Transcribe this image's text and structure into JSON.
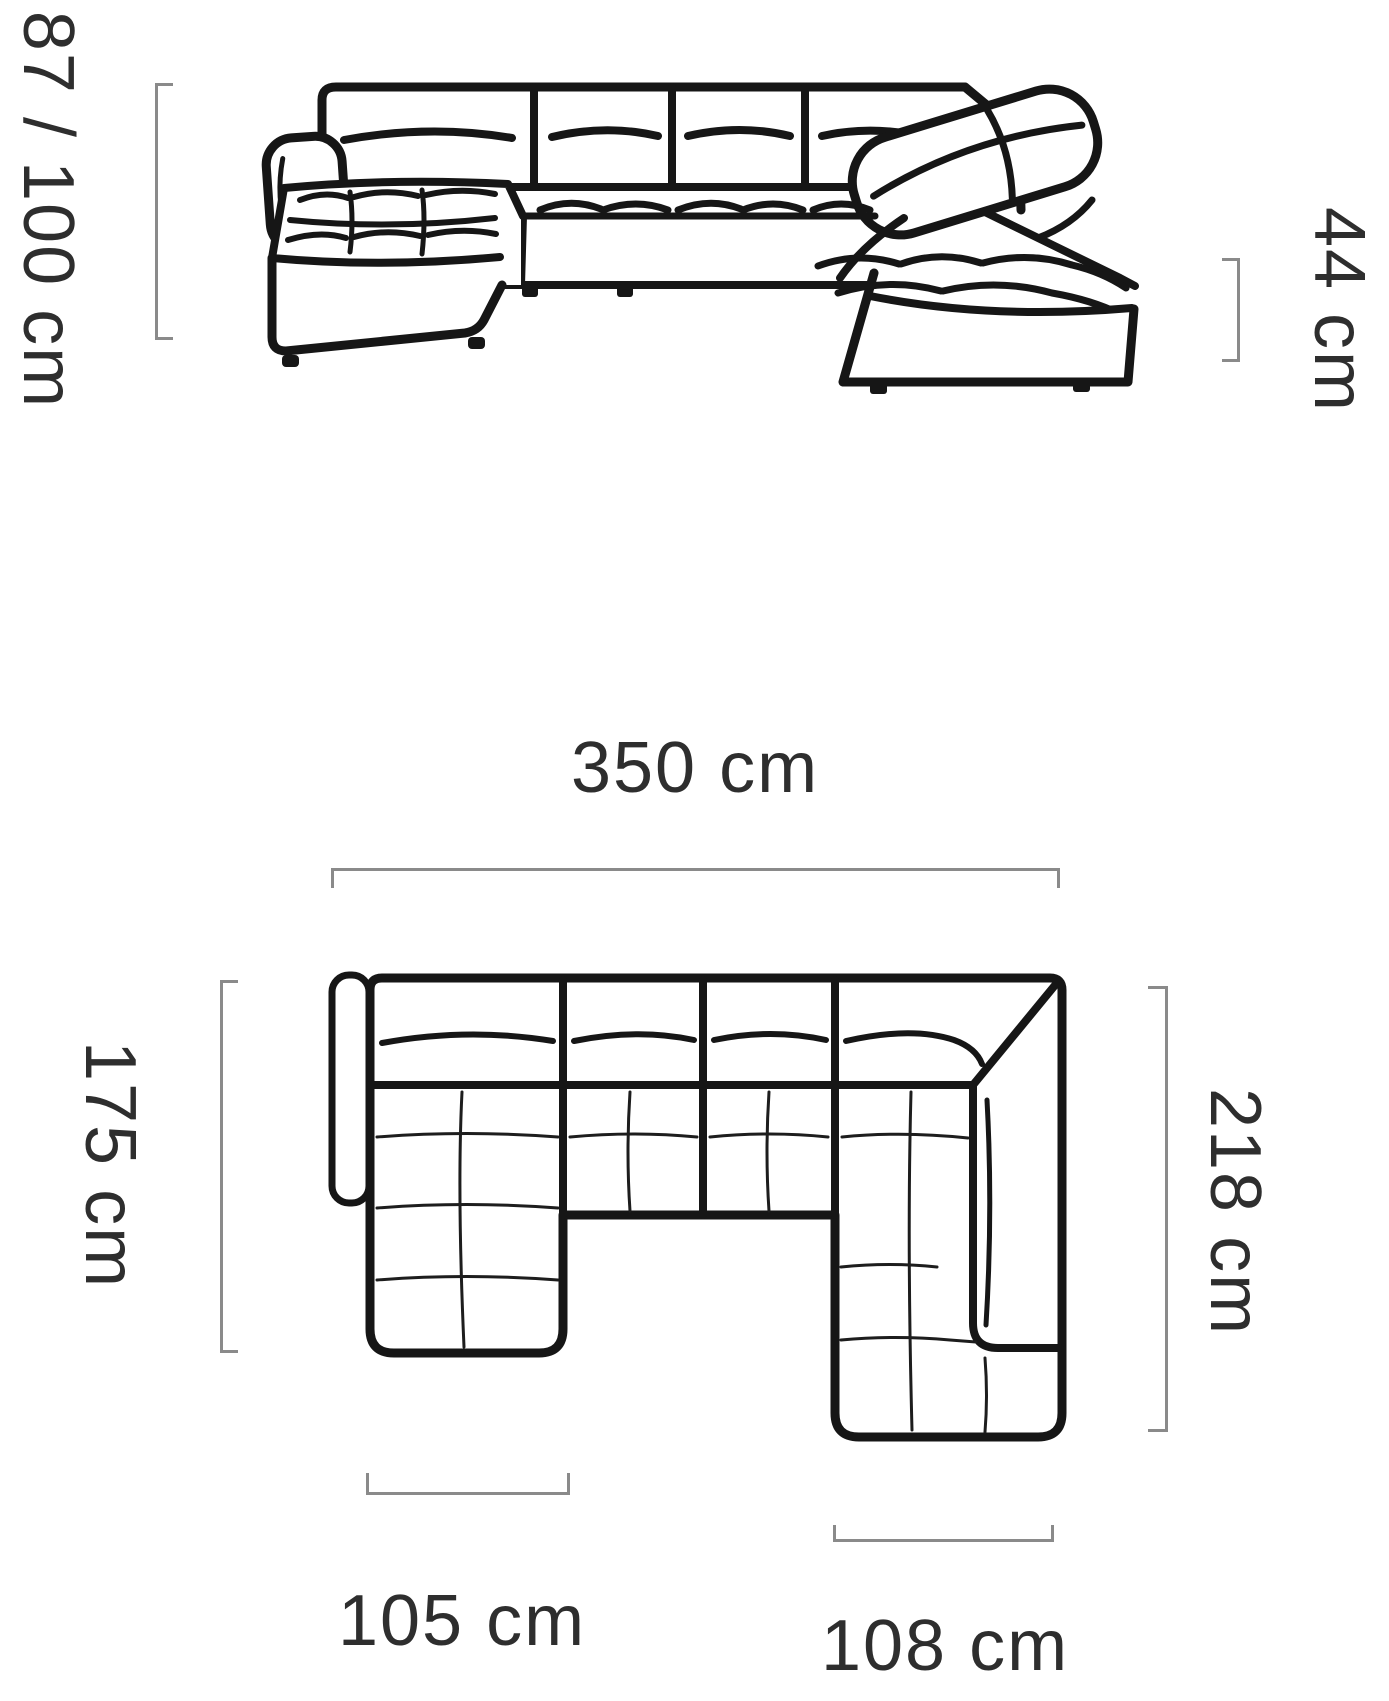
{
  "diagram": {
    "type": "furniture-dimension-drawing",
    "subject": "corner-sofa",
    "views": {
      "front": "sofa-front-elevation",
      "plan": "sofa-top-plan"
    },
    "dimensions": {
      "height": "87 / 100 cm",
      "seat_height": "44 cm",
      "total_width": "350 cm",
      "left_depth": "175 cm",
      "right_depth": "218 cm",
      "chaise_width": "105 cm",
      "right_section_width": "108 cm"
    },
    "colors": {
      "background": "#ffffff",
      "line": "#161616",
      "bracket": "#8a8a8a",
      "text": "#2e2e2e"
    }
  }
}
